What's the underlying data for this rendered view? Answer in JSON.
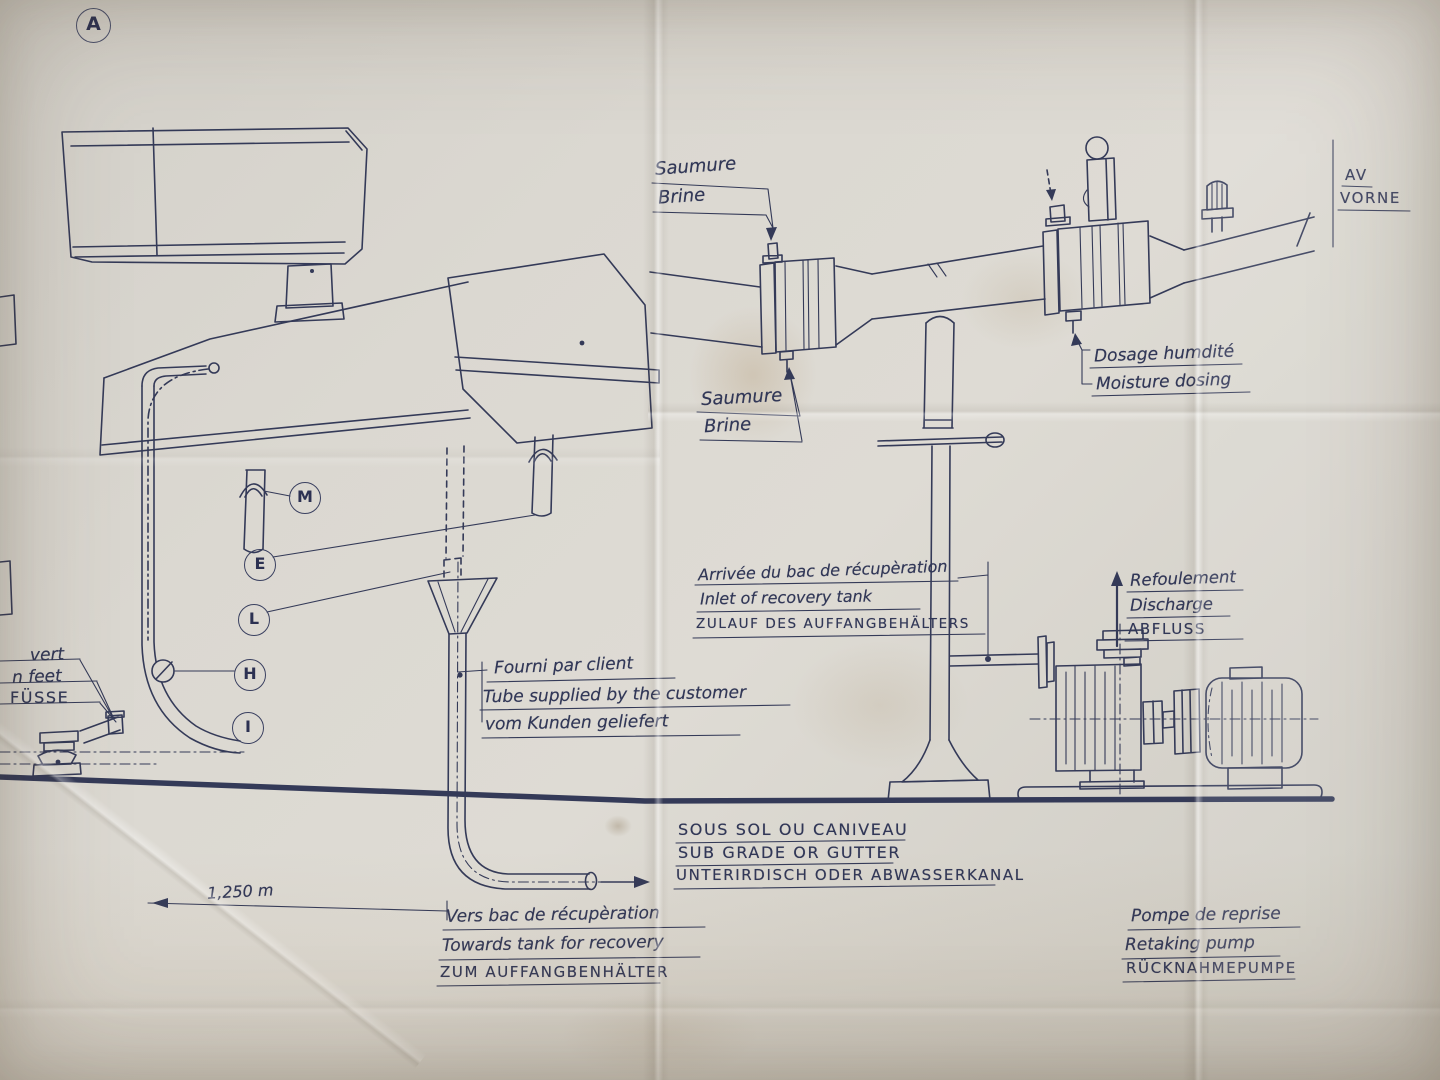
{
  "palette": {
    "paper": "#d9d6cf",
    "ink": "#313757"
  },
  "markers": {
    "section": "A",
    "callouts": [
      "M",
      "E",
      "L",
      "H",
      "I"
    ]
  },
  "labels": {
    "brine_top": {
      "fr": "Saumure",
      "en": "Brine"
    },
    "front_marker": {
      "fr": "AV",
      "de": "VORNE"
    },
    "brine_mid": {
      "fr": "Saumure",
      "en": "Brine"
    },
    "moisture_dosing": {
      "fr": "Dosage humdité",
      "en": "Moisture dosing"
    },
    "recovery_inlet": {
      "fr": "Arrivée du bac de récupèration",
      "en": "Inlet of recovery tank",
      "de": "ZULAUF DES AUFFANGBEHÄLTERS"
    },
    "discharge": {
      "fr": "Refoulement",
      "en": "Discharge",
      "de": "ABFLUSS"
    },
    "machine_feet_partial": {
      "fr": "vert",
      "en": "n feet",
      "de": "FÜSSE"
    },
    "customer_tube": {
      "fr": "Fourni par client",
      "en": "Tube supplied by the customer",
      "de": "vom Kunden geliefert"
    },
    "subgrade": {
      "fr": "SOUS SOL OU CANIVEAU",
      "en": "SUB GRADE OR GUTTER",
      "de": "UNTERIRDISCH ODER ABWASSERKANAL"
    },
    "towards_recovery": {
      "fr": "Vers bac de récupèration",
      "en": "Towards tank for recovery",
      "de": "ZUM AUFFANGBENHÄLTER"
    },
    "retaking_pump": {
      "fr": "Pompe de reprise",
      "en": "Retaking pump",
      "de": "RÜCKNAHMEPUMPE"
    }
  },
  "dimensions": {
    "floor_run": "1,250 m"
  }
}
